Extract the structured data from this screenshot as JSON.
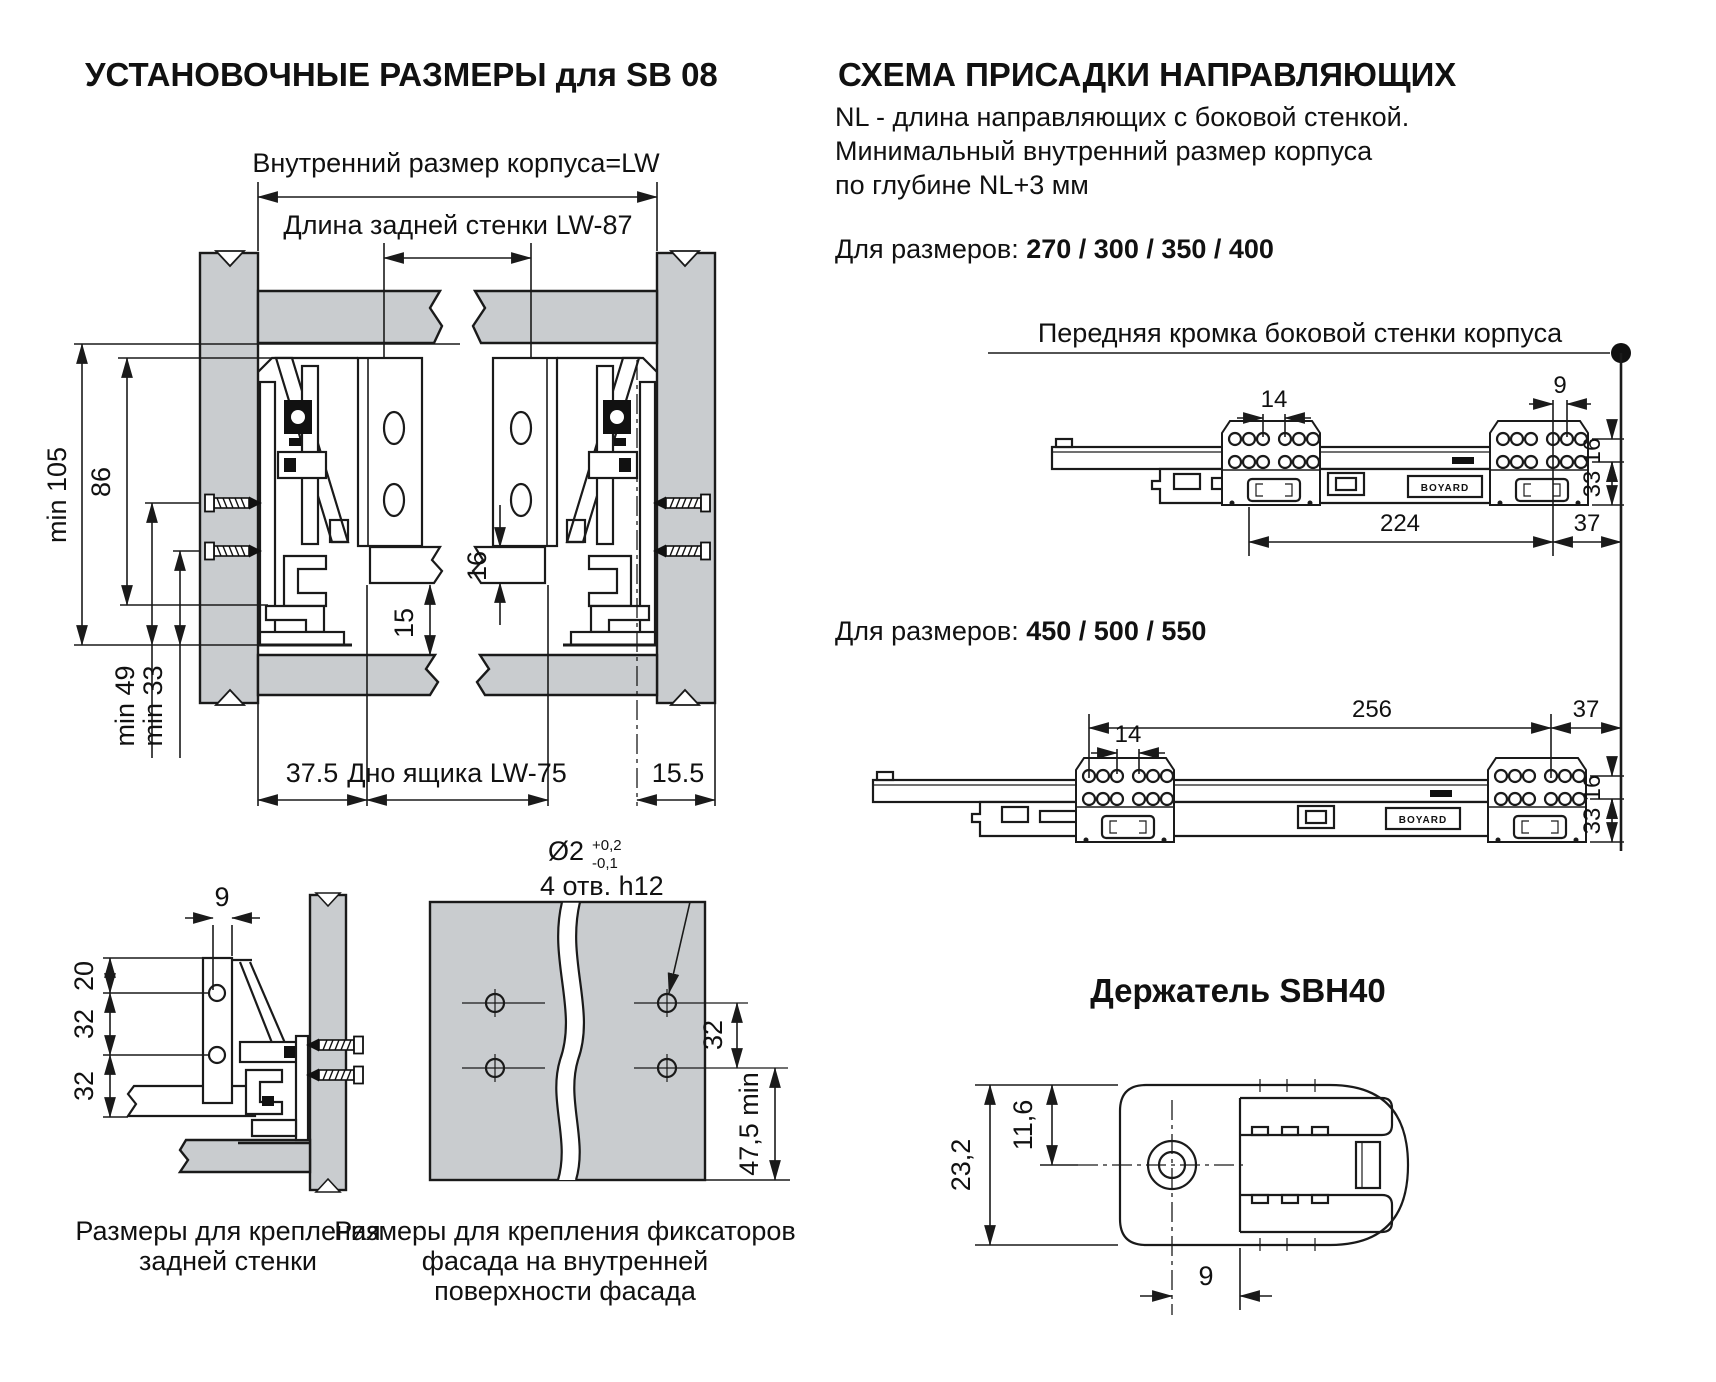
{
  "colors": {
    "panel_gray": "#c9cccf",
    "line": "#1a1a1a",
    "background": "#ffffff"
  },
  "left": {
    "title": "УСТАНОВОЧНЫЕ РАЗМЕРЫ для SB 08",
    "main_diagram": {
      "dim_inner_width": "Внутренний размер корпуса=LW",
      "dim_back_wall_length": "Длина задней стенки  LW-87",
      "dim_min105": "min 105",
      "dim_86": "86",
      "dim_min49": "min 49",
      "dim_min33": "min 33",
      "dim_16": "16",
      "dim_15": "15",
      "dim_37_5": "37.5",
      "dim_bottom": "Дно ящика  LW-75",
      "dim_15_5": "15.5"
    },
    "rear_wall_diagram": {
      "dim_9": "9",
      "dim_20": "20",
      "dim_32a": "32",
      "dim_32b": "32",
      "caption_line1": "Размеры  для крепления",
      "caption_line2": "задней стенки"
    },
    "facade_diagram": {
      "callout_dia": "Ø2",
      "callout_tol_plus": "+0,2",
      "callout_tol_minus": "-0,1",
      "callout_holes": "4 отв. h12",
      "dim_32": "32",
      "dim_47_5": "47,5 min",
      "caption_line1": "Размеры для крепления фиксаторов",
      "caption_line2": "фасада на внутренней",
      "caption_line3": "поверхности фасада"
    }
  },
  "right": {
    "title": "СХЕМА ПРИСАДКИ НАПРАВЛЯЮЩИХ",
    "note_line1": "NL - длина направляющих с боковой стенкой.",
    "note_line2": "Минимальный внутренний размер корпуса",
    "note_line3": "по глубине NL+3 мм",
    "sizes1_label": "Для размеров: ",
    "sizes1_values": "270 / 300 / 350 / 400",
    "front_edge_label": "Передняя кромка боковой стенки корпуса",
    "rail1": {
      "dim_14": "14",
      "dim_9": "9",
      "dim_16": "16",
      "dim_33": "33",
      "dim_224": "224",
      "dim_37": "37",
      "brand": "BOYARD"
    },
    "sizes2_label": "Для размеров: ",
    "sizes2_values": "450 / 500 / 550",
    "rail2": {
      "dim_256": "256",
      "dim_37": "37",
      "dim_14": "14",
      "dim_16": "16",
      "dim_33": "33",
      "brand": "BOYARD"
    },
    "holder": {
      "title": "Держатель SBH40",
      "dim_23_2": "23,2",
      "dim_11_6": "11,6",
      "dim_9": "9"
    }
  }
}
